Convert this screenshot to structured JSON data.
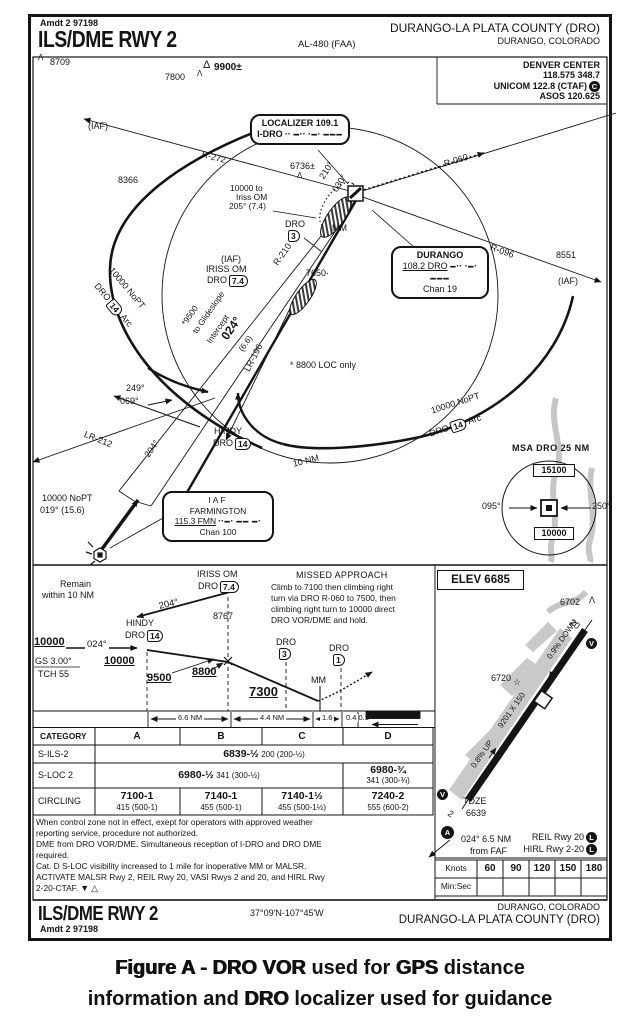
{
  "glyphs": {
    "obstacle": "Λ",
    "obstacle_big": "Δ",
    "star": "☆",
    "dot": "·",
    "tri_down": "▼",
    "tri_up": "△"
  },
  "header": {
    "amdt": "Amdt 2 97198",
    "title": "ILS/DME RWY 2",
    "al": "AL-480 (FAA)",
    "airport": "DURANGO-LA PLATA COUNTY (DRO)",
    "city": "DURANGO, COLORADO"
  },
  "comm": {
    "l1": "DENVER CENTER",
    "l2": "118.575 348.7",
    "l3": "UNICOM 122.8 (CTAF)",
    "ctaf_badge": "C",
    "l4": "ASOS 120.625"
  },
  "plan": {
    "iaf_nw": "(IAF)",
    "iaf_ne": "(IAF)",
    "o8709": "8709",
    "o7800": "7800",
    "o9900": "9900±",
    "o8366": "8366",
    "o6736": "6736±",
    "o7650": "7650·",
    "o8551": "8551",
    "r272": "R-272",
    "r060": "R-060",
    "r096": "R-096",
    "r210": "R-210",
    "lr196": "LR-196",
    "lr212": "LR-212",
    "note10000_1": "10000 to",
    "note10000_2": "Iriss OM",
    "note10000_3": "205° (7.4)",
    "crs210": "210°",
    "crs030": "030°",
    "mm": "MM",
    "dro3": "DRO",
    "dro3v": "3",
    "iriss_iaf": "(IAF)",
    "iriss_name": "IRISS OM",
    "iriss_fix": "DRO",
    "iriss_val": "7.4",
    "gs1": "*9500",
    "gs2": "to Glideslope",
    "gs3": "Intercept",
    "crs024": "024°",
    "crs024d": "(6.6)",
    "loconly": "* 8800 LOC only",
    "pt_out": "249°",
    "pt_in": "069°",
    "hindy": "HINDY",
    "hindy_fix": "DRO",
    "hindy_val": "14",
    "out204": "204°",
    "ring": "10 NM",
    "arcw1": "10000 NoPT",
    "arcw_fix": "DRO",
    "arcw_val": "14",
    "arcw2": "Arc",
    "arce1": "10000 NoPT",
    "arce_fix": "DRO",
    "arce_val": "14",
    "arce2": "Arc",
    "fmn_crs1": "10000 NoPT",
    "fmn_crs2": "019° (15.6)"
  },
  "boxes": {
    "loc1": "LOCALIZER 109.1",
    "loc2": "I-DRO",
    "loc_morse": "▪▪ ▬▪▪ ▪▬▪ ▬▬▬",
    "dur1": "DURANGO",
    "dur2": "108.2 DRO",
    "dur_morse": "▬▪▪ ▪▬▪ ▬▬▬",
    "dur3": "Chan 19",
    "fa0": "IAF",
    "fa1": "FARMINGTON",
    "fa2": "115.3 FMN",
    "fa_morse": "▪▪▬▪ ▬▬ ▬▪",
    "fa3": "Chan 100",
    "msa_title": "MSA DRO 25 NM",
    "msa_top": "15100",
    "msa_bot": "10000",
    "msa_l": "095°",
    "msa_r": "250°"
  },
  "profile": {
    "remain1": "Remain",
    "remain2": "within 10 NM",
    "iriss": "IRISS OM",
    "iriss_fix": "DRO",
    "iriss_val": "7.4",
    "crs204": "204°",
    "a8767": "8767",
    "hindy": "HINDY",
    "hindy_fix": "DRO",
    "hindy_val": "14",
    "a10000": "10000",
    "crs024": "024°",
    "a10000b": "10000",
    "gs": "GS 3.00°",
    "tch": "TCH 55",
    "a9500": "9500",
    "a8800": "8800",
    "a7300": "7300",
    "dro3": "DRO",
    "dro3v": "3",
    "dro1": "DRO",
    "dro1v": "1",
    "mm": "MM",
    "d1": "6.6 NM",
    "d2": "4.4 NM",
    "d3": "1.6",
    "d4": "0.4",
    "d5": "0.1"
  },
  "missed": {
    "title": "MISSED APPROACH",
    "l1": "Climb to 7100 then climbing right",
    "l2": "turn via DRO R-060 to 7500, then",
    "l3": "climbing right turn to 10000 direct",
    "l4": "DRO VOR/DME and hold."
  },
  "sketch": {
    "elev": "ELEV 6685",
    "o6702": "6702",
    "rwy20": "20",
    "down": "0.9% DOWN",
    "o6720": "6720",
    "dims": "9201 X 150",
    "up": "0.8% UP",
    "tdze": "TDZE",
    "tdze_v": "6639",
    "rwy2": "2",
    "faf1": "024° 6.5 NM",
    "faf2": "from FAF",
    "reil": "REIL Rwy 20",
    "hirl": "HIRL Rwy 2-20",
    "light_badge": "L",
    "vasi_badge": "V",
    "malsr_badge": "A"
  },
  "minimums": {
    "h0": "CATEGORY",
    "h1": "A",
    "h2": "B",
    "h3": "C",
    "h4": "D",
    "sils": "S-ILS-2",
    "sils_v": "6839-½",
    "sils_d": "200 (200-½)",
    "sloc": "S-LOC 2",
    "sloc_v": "6980-½",
    "sloc_d": "341 (300-½)",
    "sloc_dv": "6980-¾",
    "sloc_dd": "341 (300-¾)",
    "circ": "CIRCLING",
    "c0v": "7100-1",
    "c0d": "415 (500-1)",
    "c1v": "7140-1",
    "c1d": "455 (500-1)",
    "c2v": "7140-1½",
    "c2d": "455 (500-1½)",
    "c3v": "7240-2",
    "c3d": "555 (600-2)"
  },
  "notes": {
    "l1": "When control zone not in effect, exept for operators with approved weather",
    "l2": "reporting service, procedure not authorized.",
    "l3": "DME from DRO VOR/DME. Simultaneous reception of I-DRO and DRO DME",
    "l4": "required.",
    "l5": "Cat. D S-LOC visibility increased to 1 mile for inoperative MM or MALSR.",
    "l6": "ACTIVATE MALSR Rwy 2, REIL Rwy 20, VASI Rwys 2 and 20, and HIRL Rwy",
    "l7": "2-20-CTAF."
  },
  "speed": {
    "knots": "Knots",
    "minsec": "Min:Sec",
    "v0": "60",
    "v1": "90",
    "v2": "120",
    "v3": "150",
    "v4": "180"
  },
  "footer": {
    "title": "ILS/DME RWY 2",
    "amdt": "Amdt 2  97198",
    "coords": "37°09'N-107°45'W",
    "city": "DURANGO, COLORADO",
    "airport": "DURANGO-LA PLATA COUNTY (DRO)"
  },
  "caption": {
    "l1a": "Figure A - DRO VOR",
    "l1b": " used for ",
    "l1c": "GPS",
    "l1d": " distance",
    "l2a": "information and ",
    "l2b": "DRO",
    "l2c": " localizer used for guidance"
  }
}
